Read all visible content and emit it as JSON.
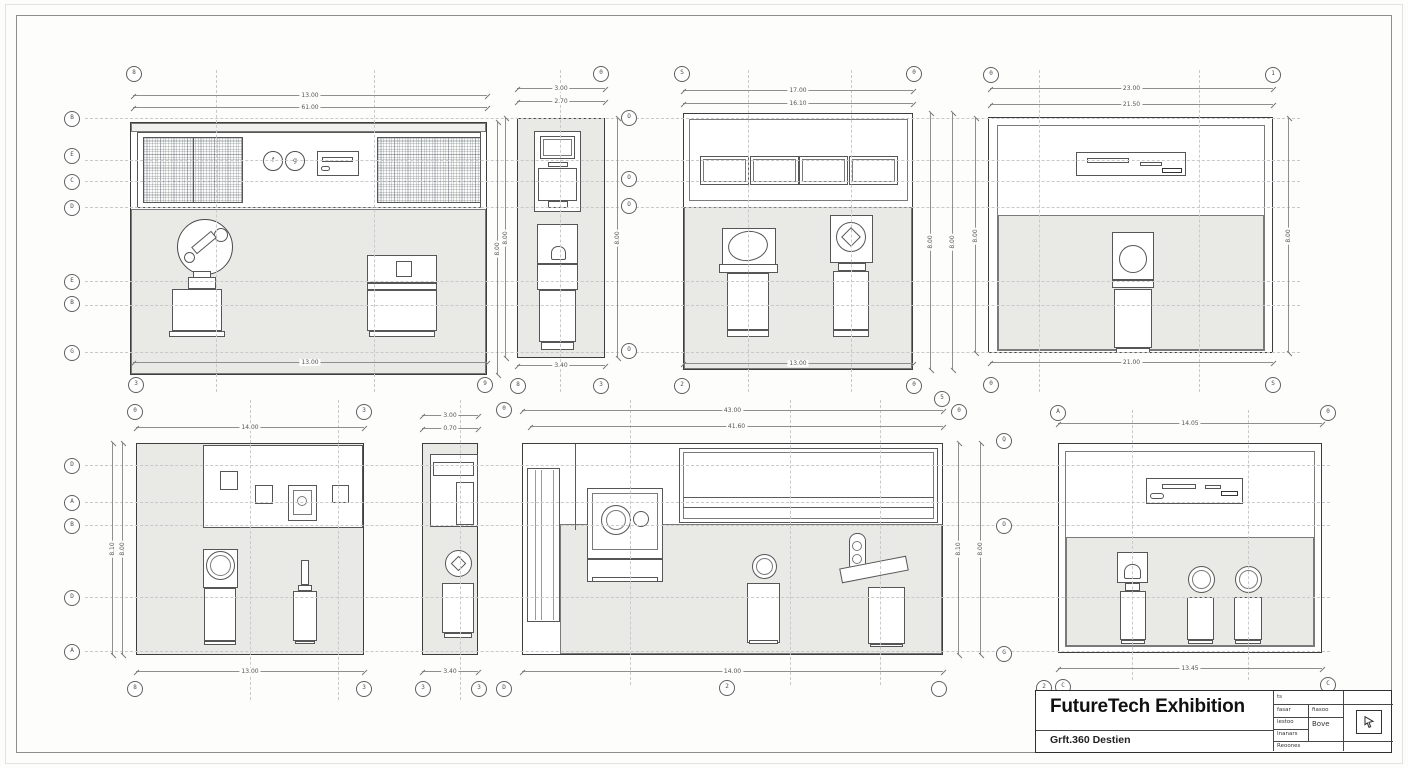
{
  "sheet": {
    "title": "FutureTech Exhibition",
    "subtitle": "Grft.360 Destien"
  },
  "title_block": {
    "r1c1": "ts",
    "r2c1": "fasar",
    "r2c2": "fiasoo",
    "r3c1": "lestoo",
    "r3c2": "Bove",
    "r4c1": "Inanars",
    "r5c1": "Reoones"
  },
  "grid_left_top": [
    "B",
    "E",
    "C",
    "D",
    "E",
    "B",
    "G"
  ],
  "grid_left_bottom": [
    "D",
    "A",
    "B",
    "D",
    "A"
  ],
  "e1": {
    "dim_top_outer": "13.00",
    "dim_top_inner": "61.00",
    "dim_bottom": "13.00",
    "dim_right": "8.00",
    "bub_top": "8",
    "bub_bl": "3",
    "bub_br": "9",
    "sym1": "f",
    "sym2": "g"
  },
  "e2": {
    "dim_top_outer": "3.00",
    "dim_top_inner": "2.70",
    "dim_bottom": "3.40",
    "dim_left": "8.00",
    "dim_right": "8.00",
    "bub_top": "0",
    "bub_bl": "8",
    "bub_br": "3",
    "col": [
      "O",
      "O",
      "O",
      "O"
    ]
  },
  "e3": {
    "dim_top_outer": "17.00",
    "dim_top_inner": "16.10",
    "dim_bottom": "13.00",
    "dim_r1": "8.00",
    "dim_r2": "8.00",
    "bub_tl": "S",
    "bub_tr": "0",
    "bub_bl": "2",
    "bub_br": "0"
  },
  "e4": {
    "dim_top_outer": "23.00",
    "dim_top_inner": "21.50",
    "dim_bottom": "21.00",
    "dim_left": "8.00",
    "dim_right": "8.00",
    "bub_tl": "0",
    "bub_tr": "1",
    "bub_bl": "0",
    "bub_br": "S"
  },
  "e5": {
    "dim_top": "14.00",
    "dim_bottom": "13.00",
    "dim_l1": "8.10",
    "dim_l2": "8.00",
    "bub_tl": "0",
    "bub_tr": "3",
    "bub_bl": "8",
    "bub_br": "3"
  },
  "e6": {
    "dim_top_outer": "3.00",
    "dim_top_inner": "0.70",
    "dim_bottom": "3.40",
    "bub_bl": "3",
    "bub_bm": "3",
    "bub_br": "D"
  },
  "e7": {
    "dim_top_outer": "43.00",
    "dim_top_inner": "41.60",
    "dim_bottom": "14.00",
    "dim_r1": "8.10",
    "dim_r2": "8.00",
    "bub_tl": "0",
    "bub_tr1": "5",
    "bub_tr2": "0",
    "bub_b": "2",
    "bub_br": ""
  },
  "e8": {
    "dim_top": "14.05",
    "dim_bottom": "13.45",
    "bub_tl": "A",
    "bub_tr": "0",
    "left": [
      "Q",
      "O",
      "G"
    ],
    "bub_b1": "2",
    "bub_b2": "C",
    "bub_b3": "C"
  }
}
